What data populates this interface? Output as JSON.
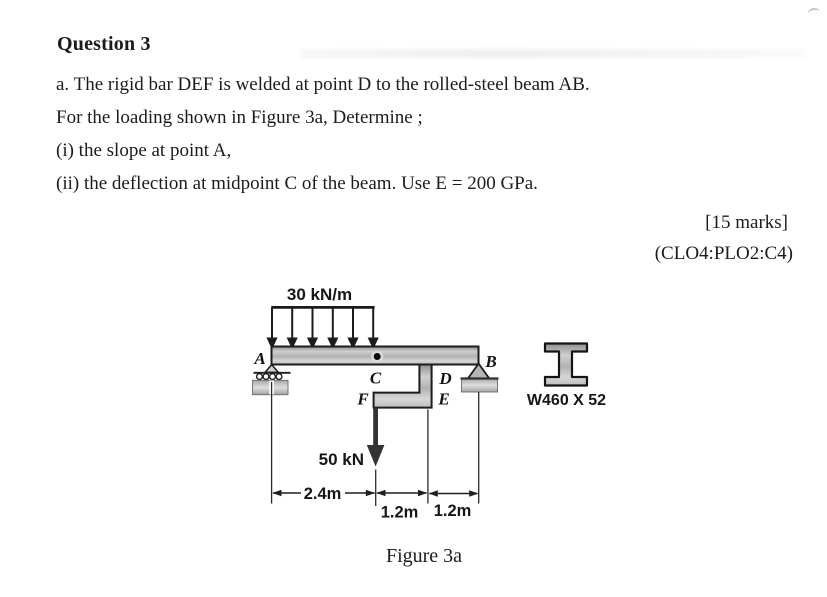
{
  "document": {
    "title": "Question 3",
    "lines": [
      "a. The rigid bar DEF is welded at point D to the rolled-steel beam AB.",
      "For the loading shown in Figure 3a, Determine ;",
      "(i) the slope at point A,",
      "(ii) the deflection at midpoint C of the beam. Use E = 200 GPa."
    ],
    "marks": "[15 marks]",
    "outcome_code": "(CLO4:PLO2:C4)"
  },
  "figure": {
    "caption": "Figure 3a",
    "labels": {
      "distributed_load": "30 kN/m",
      "point_load": "50 kN",
      "beam_section": "W460 X 52",
      "node_A": "A",
      "node_B": "B",
      "node_C": "C",
      "node_D": "D",
      "node_E": "E",
      "node_F": "F",
      "dim_left": "2.4m",
      "dim_mid": "1.2m",
      "dim_right": "1.2m"
    },
    "colors": {
      "ink": "#1a1a1a",
      "steel_gray": "#bcbcbc",
      "arrow_fill": "#333333"
    }
  }
}
